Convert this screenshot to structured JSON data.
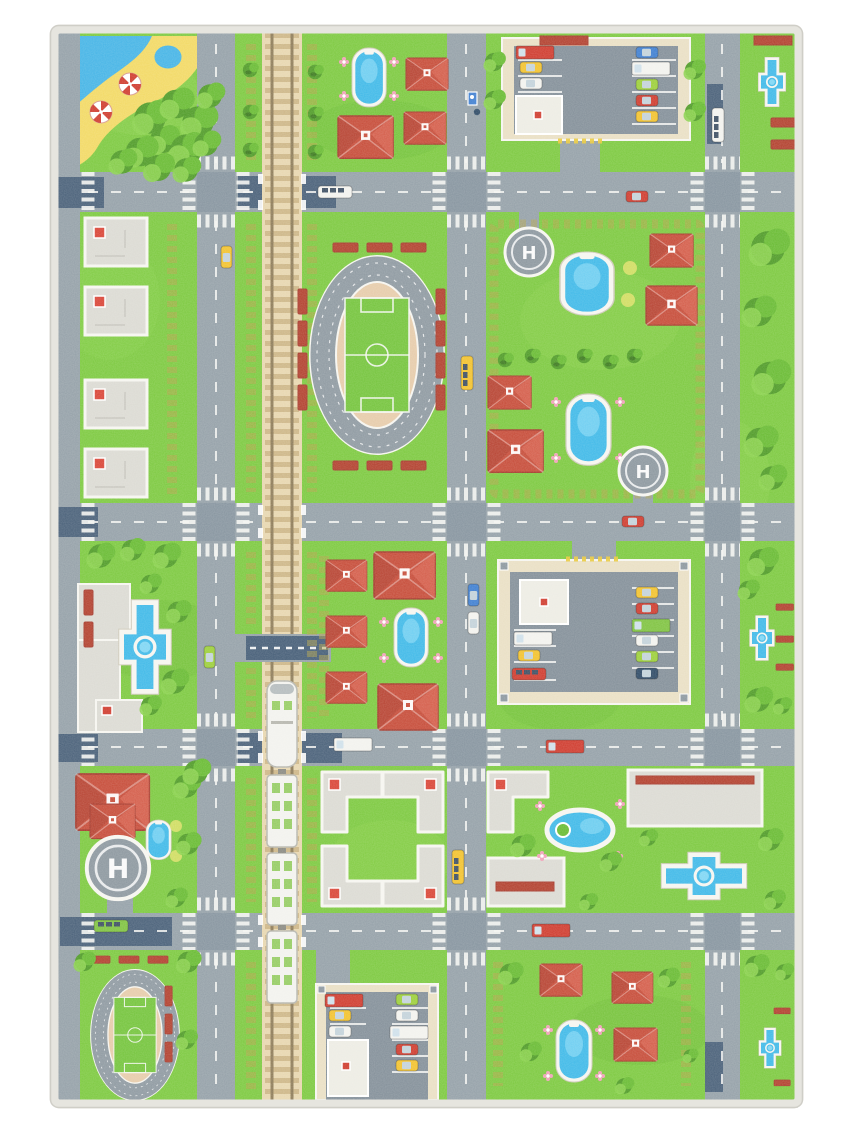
{
  "image": {
    "kind": "photograph",
    "subject": "Children's city traffic play mat rug photographed on a white background"
  },
  "labels": {
    "helipad": "H"
  },
  "colors": {
    "page_bg": "#ffffff",
    "binding": "#e6e5df",
    "binding_edge": "#c9c8c0",
    "grass": "#7cc93f",
    "grass_light": "#92d553",
    "grass_dark": "#61b02d",
    "bush_dark": "#4f9b27",
    "bush_mid": "#68bb32",
    "bush_light": "#8ad24c",
    "road": "#94a0a8",
    "road_dark": "#838f99",
    "road_navy": "#3c5571",
    "line_white": "#f4f5f2",
    "rail_base": "#e7d6af",
    "rail_tie": "#cdb687",
    "rail_steel": "#8d7b58",
    "roof_red": "#c64b38",
    "roof_dark": "#a5392c",
    "bench_red": "#b2402e",
    "building": "#dbdad3",
    "building_edge": "#f6f5f0",
    "office": "#edece4",
    "path_tan": "#e9dfc4",
    "pool_blue": "#3fb9e8",
    "pool_light": "#7fd6f4",
    "water": "#45b4e6",
    "sand": "#f2d964",
    "track_gray": "#8e99a1",
    "infield_tan": "#e6cbaa",
    "pitch_green": "#74c43c",
    "heli_gray": "#8c979f",
    "taxi_yellow": "#f2c22e",
    "car_red": "#cf3b2e",
    "car_blue": "#3f7fd1",
    "car_lime": "#9ccf3a",
    "car_white": "#f2f2ee",
    "car_navy": "#2e4a66",
    "bus_green": "#7fc341",
    "flower_pink": "#f0a0b8",
    "hedge_olive": "#b3a449",
    "hatch_yellow": "#e8c83c"
  },
  "rug": {
    "grid": {
      "horizontal_roads": 4,
      "vertical_roads": 3,
      "left_edge_road": true,
      "railway": "full-height vertical railway with bridges over roads and one level crossing"
    },
    "features": [
      "beach corner with pond and two red-white parasols",
      "large football stadium with athletics track and red bleachers",
      "small football stadium with athletics track",
      "three parking lots filled with parked cars",
      "three helipads marked H",
      "white passenger train on the railway",
      "oval swimming pools with flowers",
      "cross-shaped fountains",
      "red-roofed houses",
      "light gray apartment and L-shaped courtyard buildings",
      "park plaza with trees, benches and fountain",
      "red benches along the right edge",
      "cars, buses and trucks on the roads",
      "zebra crosswalks at every intersection",
      "bus stop sign with waiting pedestrian"
    ]
  }
}
